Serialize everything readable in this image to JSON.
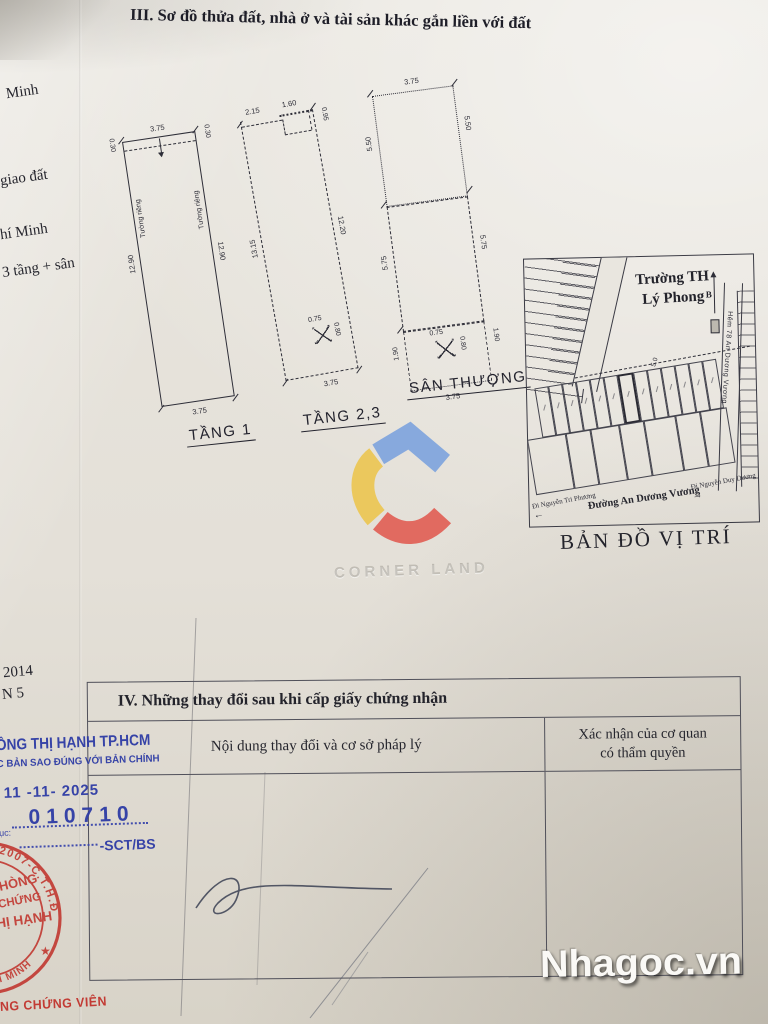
{
  "photo": {
    "site_watermark": "Nhagoc.vn",
    "logo_text": "CORNER LAND",
    "logo_colors": {
      "blue": "#7aa2de",
      "yellow": "#ecc54d",
      "red": "#e15a50"
    }
  },
  "section3": {
    "title": "III. Sơ đồ thửa đất, nhà ở và tài sản khác gắn liền với đất"
  },
  "margin": {
    "frag1": "Minh",
    "frag2": "giao đất",
    "frag3": "hí Minh",
    "frag4": "3 tầng + sân",
    "frag5": "2014",
    "frag6": "N 5"
  },
  "plans": [
    {
      "label": "TẦNG 1",
      "dims": {
        "top": "3.75",
        "top_left": "0.30",
        "top_right": "0.30",
        "left_wall": "Tường riêng",
        "left": "12.90",
        "right_wall": "Tường riêng",
        "right": "12.90",
        "bottom": "3.75"
      }
    },
    {
      "label": "TẦNG 2,3",
      "dims": {
        "top_left": "2.15",
        "top_right": "1.60",
        "right_top": "0.95",
        "left": "13.15",
        "right": "12.20",
        "bottom": "3.75",
        "stair_w": "0.75",
        "stair_h": "0.80"
      }
    },
    {
      "label": "SÂN THƯỢNG",
      "dims": {
        "top": "3.75",
        "upper_left": "5.50",
        "upper_right": "5.50",
        "mid_left": "5.75",
        "mid_right": "5.75",
        "lower_left": "1.90",
        "lower_right": "1.90",
        "stair_w": "0.75",
        "stair_h": "0.80",
        "bottom": "3.75"
      }
    }
  ],
  "map": {
    "caption": "BẢN ĐỒ VỊ TRÍ",
    "school_line1": "Trường TH",
    "school_line2": "Lý Phong",
    "north_label": "B",
    "alley_label": "Hẻm 78 An Dương Vương",
    "lot_width": "5.0",
    "street": "Đường An Dương Vương",
    "dir_left": "Đi Nguyễn Tri Phương",
    "dir_right": "Đi Nguyễn Duy Dương"
  },
  "section4": {
    "title": "IV. Những thay đổi sau khi cấp giấy chứng nhận",
    "col_content": "Nội dung thay đổi và cơ sở pháp lý",
    "col_confirm_line1": "Xác nhận của cơ quan",
    "col_confirm_line2": "có thẩm quyền"
  },
  "blue_stamp": {
    "line1": "ỒNG THỊ HẠNH TP.HCM",
    "line2": "C BẢN SAO ĐÚNG VỚI BẢN CHÍNH",
    "date": "11 -11- 2025",
    "number": "010710",
    "label": "ục:",
    "code": "-SCT/BS",
    "color": "#2e3ba5"
  },
  "red_stamp": {
    "arc_top": "02007-C.T.H.Đ",
    "star": "★",
    "arc_bottom": "T.P HỒ CHÍ MINH",
    "line1": "HÒNG",
    "line2": "CHỨNG",
    "line3": "HỊ HẠNH",
    "footer": "NG CHỨNG VIÊN",
    "color": "#c23b34"
  }
}
